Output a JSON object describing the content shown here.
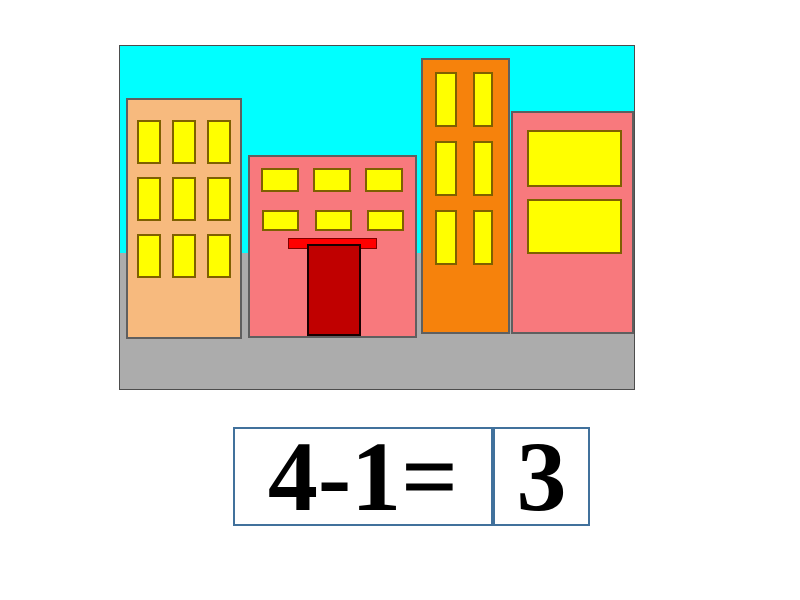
{
  "scene": {
    "description": "city street with four colored buildings under a cyan sky",
    "building_count": 4,
    "colors": {
      "sky": "#00FFFF",
      "road": "#ACACAC",
      "building_tan": "#F7BA7E",
      "building_pink": "#F8797D",
      "building_orange": "#F6820C",
      "window_yellow": "#FFFF00",
      "door_dark_red": "#C00000",
      "awning_red": "#FF0000",
      "frame_border": "#4d4d4d"
    },
    "buildings": [
      {
        "name": "tan building",
        "color": "#F7BA7E",
        "window_count": 9
      },
      {
        "name": "pink building with red door",
        "color": "#F8797D",
        "window_count": 6
      },
      {
        "name": "orange tall building",
        "color": "#F6820C",
        "window_count": 6
      },
      {
        "name": "pink building",
        "color": "#F8797D",
        "window_count": 2
      }
    ]
  },
  "equation": {
    "expression": "4-1=",
    "answer": "3",
    "border_color": "#41719C",
    "text_color": "#000000"
  }
}
